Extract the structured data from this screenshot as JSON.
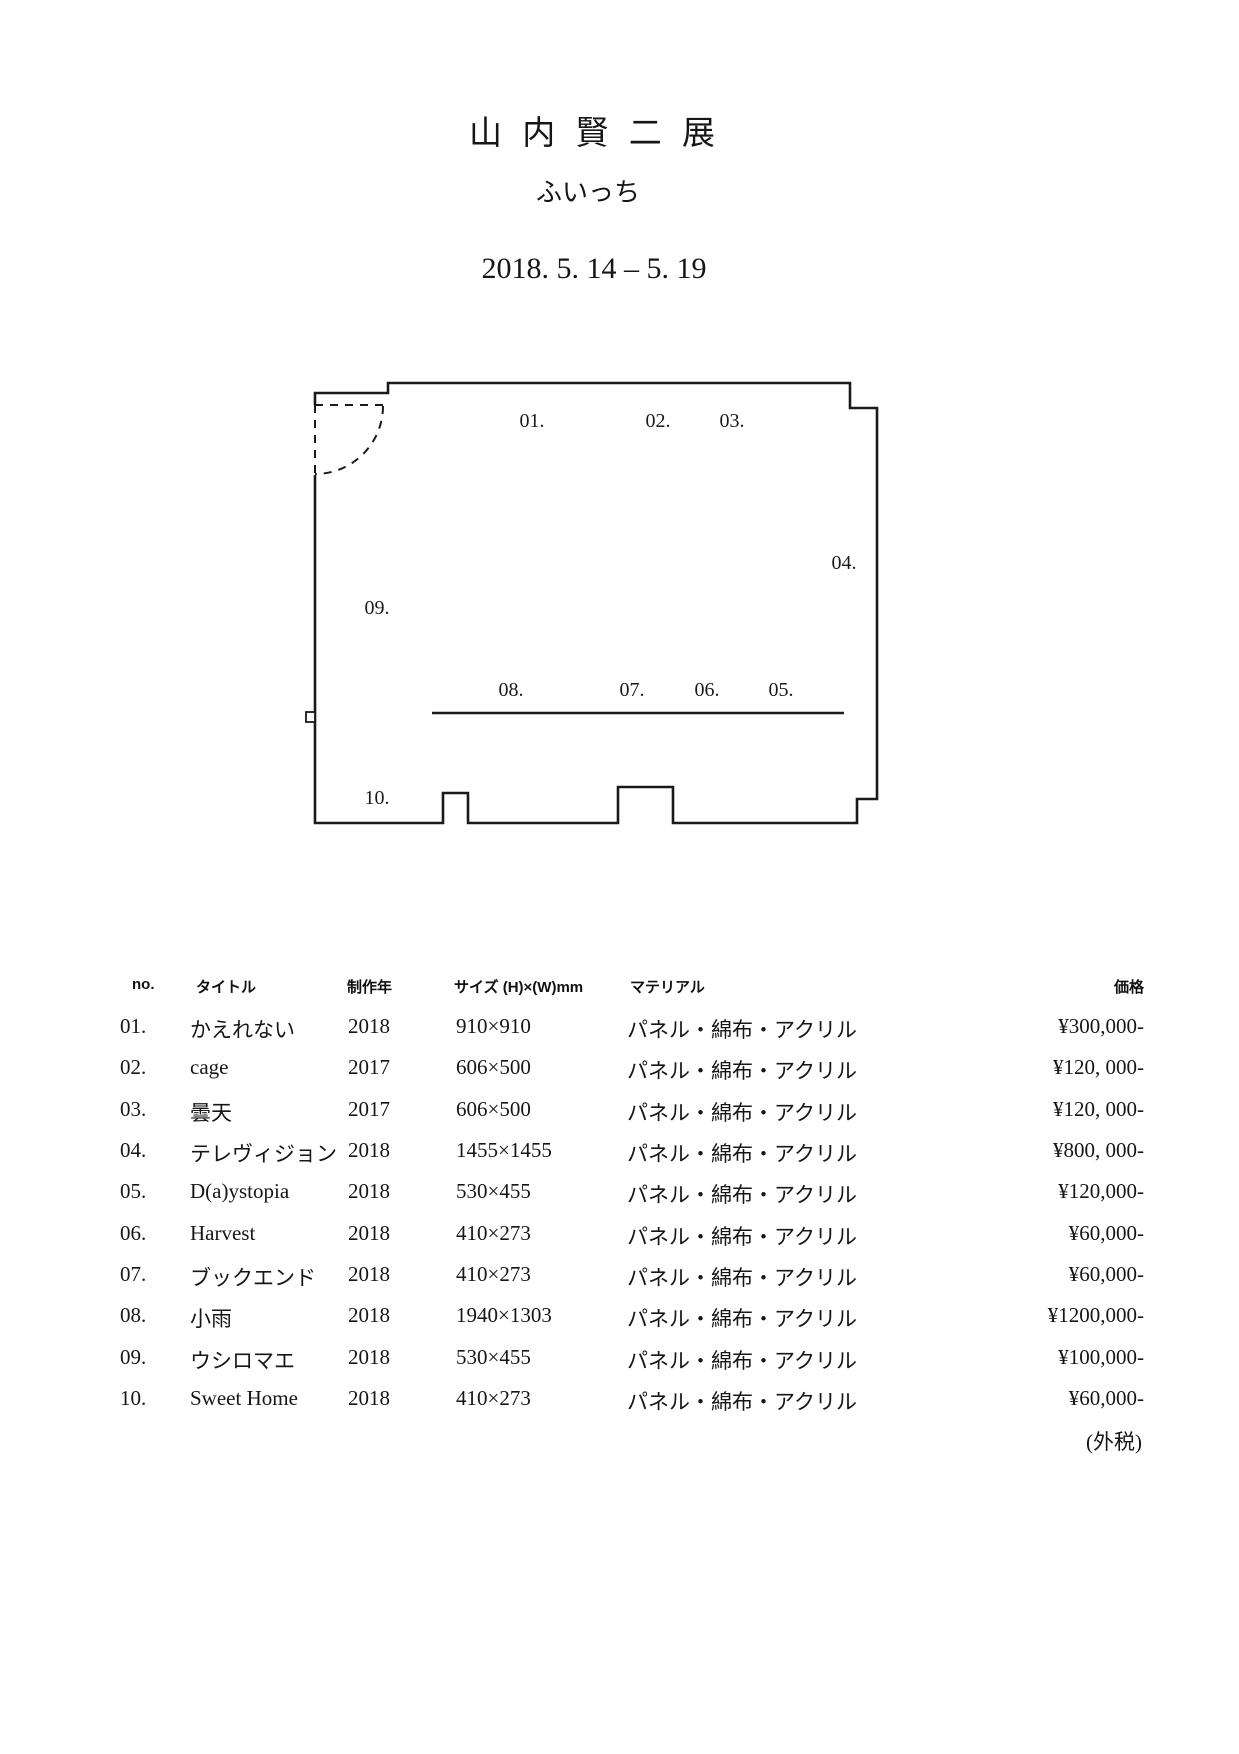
{
  "page": {
    "title": "山 内 賢 二 展",
    "subtitle": "ふいっち",
    "dates": "2018. 5. 14 – 5. 19",
    "tax_note": "(外税)"
  },
  "floorplan": {
    "labels": [
      {
        "text": "01.",
        "x": 532,
        "y": 420
      },
      {
        "text": "02.",
        "x": 658,
        "y": 420
      },
      {
        "text": "03.",
        "x": 732,
        "y": 420
      },
      {
        "text": "04.",
        "x": 844,
        "y": 562
      },
      {
        "text": "05.",
        "x": 781,
        "y": 689
      },
      {
        "text": "06.",
        "x": 707,
        "y": 689
      },
      {
        "text": "07.",
        "x": 632,
        "y": 689
      },
      {
        "text": "08.",
        "x": 511,
        "y": 689
      },
      {
        "text": "09.",
        "x": 377,
        "y": 607
      },
      {
        "text": "10.",
        "x": 377,
        "y": 797
      }
    ]
  },
  "table": {
    "headers": [
      "no.",
      "タイトル",
      "制作年",
      "サイズ (H)×(W)mm",
      "マテリアル",
      "価格"
    ],
    "rows": [
      [
        "01.",
        "かえれない",
        "2018",
        "910×910",
        "パネル・綿布・アクリル",
        "¥300,000-"
      ],
      [
        "02.",
        "cage",
        "2017",
        "606×500",
        "パネル・綿布・アクリル",
        "¥120, 000-"
      ],
      [
        "03.",
        "曇天",
        "2017",
        "606×500",
        "パネル・綿布・アクリル",
        "¥120, 000-"
      ],
      [
        "04.",
        "テレヴィジョン",
        "2018",
        "1455×1455",
        "パネル・綿布・アクリル",
        "¥800, 000-"
      ],
      [
        "05.",
        "D(a)ystopia",
        "2018",
        "530×455",
        "パネル・綿布・アクリル",
        "¥120,000-"
      ],
      [
        "06.",
        "Harvest",
        "2018",
        "410×273",
        "パネル・綿布・アクリル",
        "¥60,000-"
      ],
      [
        "07.",
        "ブックエンド",
        "2018",
        "410×273",
        "パネル・綿布・アクリル",
        "¥60,000-"
      ],
      [
        "08.",
        "小雨",
        "2018",
        "1940×1303",
        "パネル・綿布・アクリル",
        "¥1200,000-"
      ],
      [
        "09.",
        "ウシロマエ",
        "2018",
        "530×455",
        "パネル・綿布・アクリル",
        "¥100,000-"
      ],
      [
        "10.",
        "Sweet Home",
        "2018",
        "410×273",
        "パネル・綿布・アクリル",
        "¥60,000-"
      ]
    ]
  }
}
